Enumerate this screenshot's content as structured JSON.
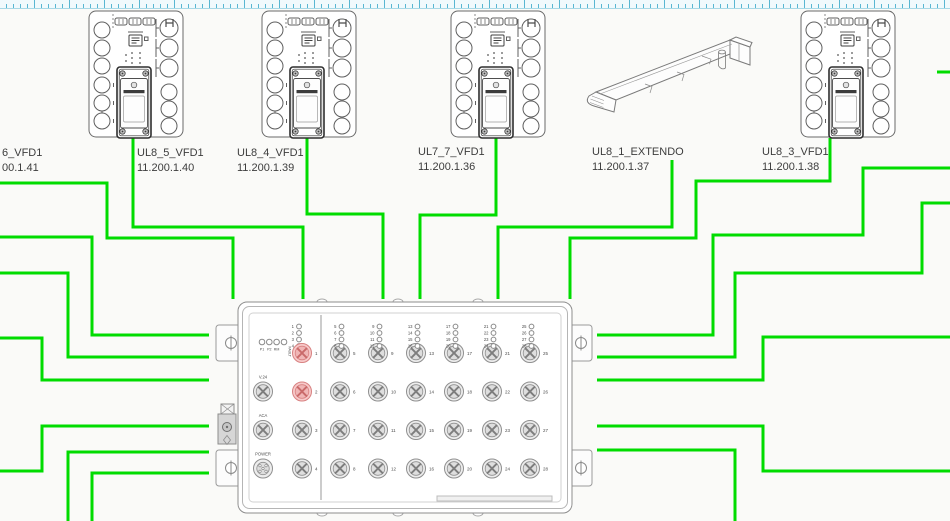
{
  "canvas": {
    "background": "#fafaf8",
    "wire_color": "#00dc00",
    "wire_width": 3
  },
  "ruler": {
    "tick_color": "#58b6d2",
    "background": "#f0f9fc",
    "border_color": "#a6d8e6"
  },
  "devices": [
    {
      "id": "dev-cutoff",
      "kind": "label-only",
      "name": "6_VFD1",
      "ip": "00.1.41"
    },
    {
      "id": "dev-ul8-5",
      "kind": "vfd",
      "name": "UL8_5_VFD1",
      "ip": "11.200.1.40"
    },
    {
      "id": "dev-ul8-4",
      "kind": "vfd",
      "name": "UL8_4_VFD1",
      "ip": "11.200.1.39"
    },
    {
      "id": "dev-ul7-7",
      "kind": "vfd",
      "name": "UL7_7_VFD1",
      "ip": "11.200.1.36"
    },
    {
      "id": "dev-ul8-1",
      "kind": "extendo",
      "name": "UL8_1_EXTENDO",
      "ip": "11.200.1.37"
    },
    {
      "id": "dev-ul8-3",
      "kind": "vfd",
      "name": "UL8_3_VFD1",
      "ip": "11.200.1.38"
    }
  ],
  "switch": {
    "status_leds": [
      "P1",
      "P2",
      "RM",
      "FAULT"
    ],
    "side_ports": [
      "V.24",
      "ACA",
      "POWER"
    ],
    "left_port_numbers": [
      1,
      2,
      3,
      4
    ],
    "highlighted_ports": [
      1,
      2
    ],
    "port_columns": [
      [
        5,
        6,
        7,
        8
      ],
      [
        9,
        10,
        11,
        12
      ],
      [
        13,
        14,
        15,
        16
      ],
      [
        17,
        18,
        19,
        20
      ],
      [
        21,
        22,
        23,
        24
      ],
      [
        25,
        26,
        27,
        28
      ]
    ],
    "highlight_fill": "#f7caca",
    "highlight_stroke": "#d88181"
  },
  "wiring": {
    "routes": [
      [
        [
          0,
          183
        ],
        [
          107,
          183
        ],
        [
          107,
          238
        ],
        [
          233,
          238
        ],
        [
          233,
          299
        ]
      ],
      [
        [
          133,
          138
        ],
        [
          133,
          227
        ],
        [
          303,
          227
        ],
        [
          303,
          299
        ]
      ],
      [
        [
          307,
          138
        ],
        [
          307,
          214
        ],
        [
          383,
          214
        ],
        [
          383,
          299
        ]
      ],
      [
        [
          496,
          138
        ],
        [
          496,
          215
        ],
        [
          420,
          215
        ],
        [
          420,
          299
        ]
      ],
      [
        [
          672,
          160
        ],
        [
          672,
          227
        ],
        [
          498,
          227
        ],
        [
          498,
          299
        ]
      ],
      [
        [
          830,
          138
        ],
        [
          830,
          181
        ],
        [
          696,
          181
        ],
        [
          696,
          238
        ],
        [
          570,
          238
        ],
        [
          570,
          299
        ]
      ],
      [
        [
          0,
          237
        ],
        [
          92,
          237
        ],
        [
          92,
          335
        ],
        [
          209,
          335
        ]
      ],
      [
        [
          0,
          273
        ],
        [
          68,
          273
        ],
        [
          68,
          357
        ],
        [
          209,
          357
        ]
      ],
      [
        [
          0,
          338
        ],
        [
          42,
          338
        ],
        [
          42,
          380
        ],
        [
          209,
          380
        ]
      ],
      [
        [
          0,
          471
        ],
        [
          42,
          471
        ],
        [
          42,
          426
        ],
        [
          209,
          426
        ]
      ],
      [
        [
          68,
          521
        ],
        [
          68,
          452
        ],
        [
          209,
          452
        ]
      ],
      [
        [
          92,
          521
        ],
        [
          92,
          473
        ],
        [
          209,
          473
        ]
      ],
      [
        [
          597,
          335
        ],
        [
          713,
          335
        ],
        [
          713,
          235
        ],
        [
          863,
          235
        ],
        [
          863,
          168
        ],
        [
          950,
          168
        ]
      ],
      [
        [
          597,
          357
        ],
        [
          735,
          357
        ],
        [
          735,
          273
        ],
        [
          922,
          273
        ],
        [
          922,
          203
        ],
        [
          950,
          203
        ]
      ],
      [
        [
          597,
          380
        ],
        [
          763,
          380
        ],
        [
          763,
          337
        ],
        [
          950,
          337
        ]
      ],
      [
        [
          597,
          426
        ],
        [
          763,
          426
        ],
        [
          763,
          471
        ],
        [
          950,
          471
        ]
      ],
      [
        [
          597,
          450
        ],
        [
          735,
          450
        ],
        [
          735,
          521
        ]
      ],
      [
        [
          937,
          72
        ],
        [
          950,
          72
        ]
      ]
    ]
  }
}
